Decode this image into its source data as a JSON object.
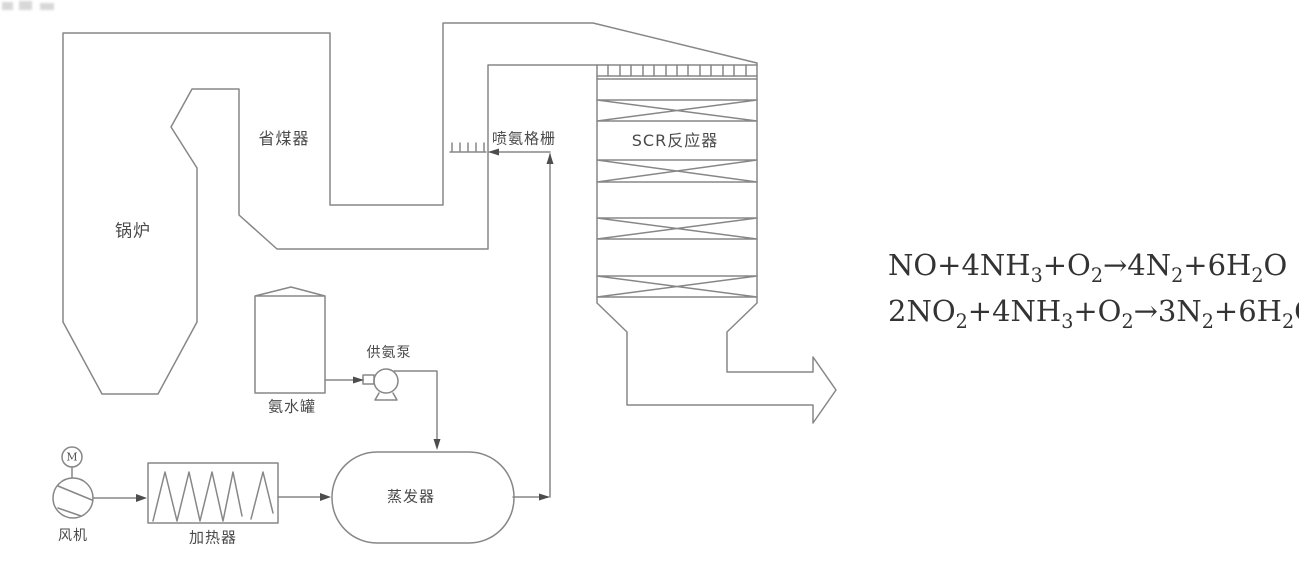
{
  "diagram_title": "SCR flue-gas denitrification process diagram",
  "labels": {
    "boiler": "锅炉",
    "economizer": "省煤器",
    "ammonia_injection_grid": "喷氨格栅",
    "scr_reactor": "SCR反应器",
    "ammonia_tank": "氨水罐",
    "ammonia_pump": "供氨泵",
    "evaporator": "蒸发器",
    "fan": "风机",
    "heater": "加热器",
    "motor": "M"
  },
  "equations": [
    {
      "text": "NO+4NH3+O2→4N2+6H2O",
      "segments": [
        {
          "t": "NO+4NH"
        },
        {
          "s": "3"
        },
        {
          "t": "+O"
        },
        {
          "s": "2"
        },
        {
          "t": "→4N"
        },
        {
          "s": "2"
        },
        {
          "t": "+6H"
        },
        {
          "s": "2"
        },
        {
          "t": "O"
        }
      ]
    },
    {
      "text": "2NO2+4NH3+O2→3N2+6H2O",
      "segments": [
        {
          "t": "2NO"
        },
        {
          "s": "2"
        },
        {
          "t": "+4NH"
        },
        {
          "s": "3"
        },
        {
          "t": "+O"
        },
        {
          "s": "2"
        },
        {
          "t": "→3N"
        },
        {
          "s": "2"
        },
        {
          "t": "+6H"
        },
        {
          "s": "2"
        },
        {
          "t": "O"
        }
      ]
    }
  ],
  "colors": {
    "background": "#ffffff",
    "line": "#878787",
    "label_text": "#4a4a4a",
    "equation_text": "#333333",
    "arrowhead": "#4d4d4d"
  }
}
